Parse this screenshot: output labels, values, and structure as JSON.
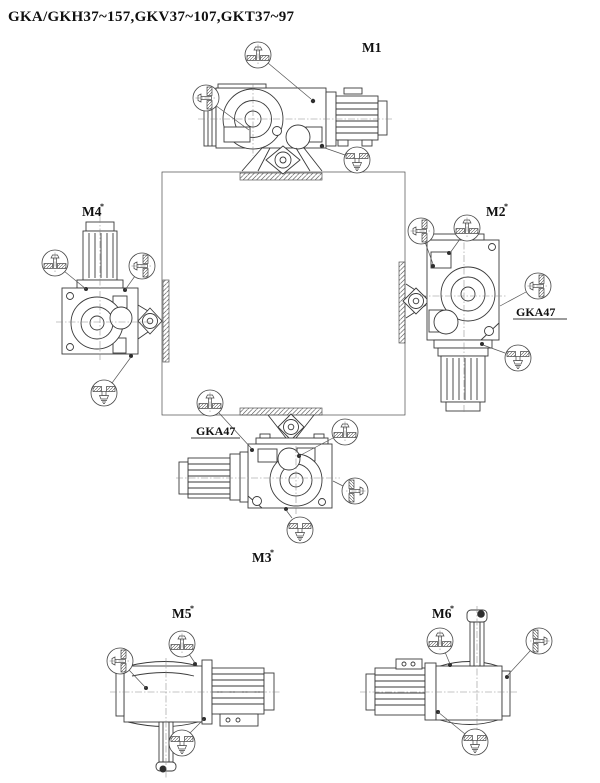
{
  "title": "GKA/GKH37~157,GKV37~107,GKT37~97",
  "positions": {
    "m1": {
      "label": "M1"
    },
    "m2": {
      "label": "M2",
      "sup": "*",
      "note": "GKA47"
    },
    "m3": {
      "label": "M3",
      "sup": "*",
      "note": "GKA47"
    },
    "m4": {
      "label": "M4",
      "sup": "*"
    },
    "m5": {
      "label": "M5",
      "sup": "*"
    },
    "m6": {
      "label": "M6",
      "sup": "*"
    }
  },
  "symbols": {
    "vent": "breather-vent-plug",
    "level": "oil-level-plug",
    "drain": "oil-drain-plug"
  },
  "colors": {
    "line": "#3a3a3a",
    "background": "#ffffff",
    "text": "#101010"
  }
}
